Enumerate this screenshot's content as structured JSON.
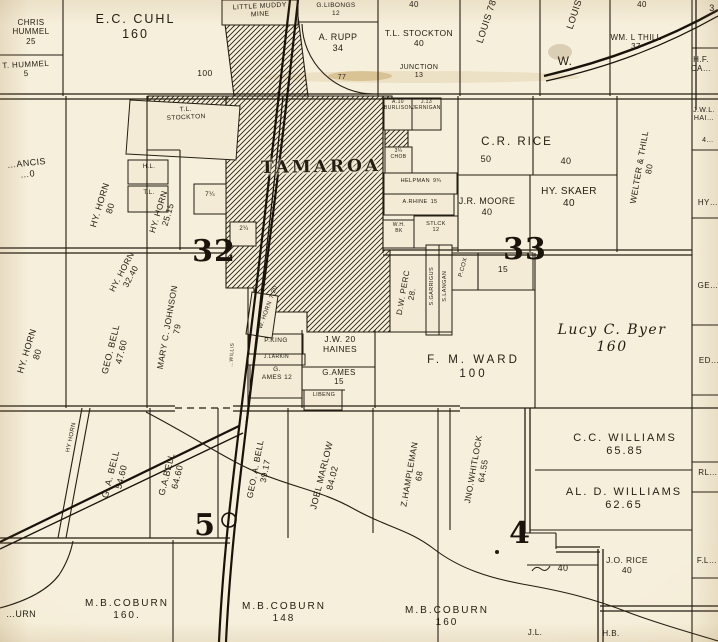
{
  "map": {
    "type": "plat-map",
    "town_name": "TAMAROA",
    "mine_name": "LITTLE MUDDY MINE",
    "section_numbers": [
      "32",
      "33",
      "5",
      "4"
    ],
    "paper_color": "#f3ebd5",
    "ink_color": "#241c10",
    "labels": [
      {
        "t": "CHRIS HUMMEL",
        "v": "25"
      },
      {
        "t": "T. HUMMEL",
        "v": "5"
      },
      {
        "t": "E.C. CUHL",
        "v": "160"
      },
      {
        "t": "100"
      },
      {
        "t": "LITTLE MUDDY MINE"
      },
      {
        "t": "G.LIBONGS",
        "v": "12"
      },
      {
        "t": "A. RUPP",
        "v": "34"
      },
      {
        "t": "77"
      },
      {
        "t": "T.L. STOCKTON",
        "v": "40"
      },
      {
        "t": "JUNCTION",
        "v": "13"
      },
      {
        "t": "LOUIS",
        "v": "78"
      },
      {
        "t": "LOUIS",
        "v": "78"
      },
      {
        "t": "W."
      },
      {
        "t": "WM. L THILL",
        "v": "37"
      },
      {
        "t": "H.F.",
        "v": "CA…"
      },
      {
        "t": "40"
      },
      {
        "t": "40"
      },
      {
        "t": "3"
      },
      {
        "t": "…ANCIS",
        "v": "…0"
      },
      {
        "t": "HY. HORN",
        "v": "80"
      },
      {
        "t": "HY. HORN",
        "v": "25.15"
      },
      {
        "t": "T.L.",
        "v": "STOCKTON"
      },
      {
        "t": "H.L."
      },
      {
        "t": "T.L."
      },
      {
        "t": "7¼"
      },
      {
        "t": "2¼"
      },
      {
        "t": "TAMAROA"
      },
      {
        "t": "A.10",
        "v": "BURLISON"
      },
      {
        "t": "J.13",
        "v": "JERNIGAN"
      },
      {
        "t": "3¼",
        "v": "CHOB"
      },
      {
        "t": "HELPMAN",
        "v": "9¾"
      },
      {
        "t": "A.RHINE",
        "v": "15"
      },
      {
        "t": "W.H.",
        "v": "BK"
      },
      {
        "t": "STLCK",
        "v": "12"
      },
      {
        "t": "C.R. RICE"
      },
      {
        "t": "50"
      },
      {
        "t": "40"
      },
      {
        "t": "J.R. MOORE",
        "v": "40"
      },
      {
        "t": "HY. SKAER",
        "v": "40"
      },
      {
        "t": "WELTER & THILL",
        "v": "80"
      },
      {
        "t": "J.W.L.",
        "v": "HAI…"
      },
      {
        "t": "4…"
      },
      {
        "t": "HY…"
      },
      {
        "t": "32"
      },
      {
        "t": "33"
      },
      {
        "t": "HY. HORN",
        "v": "80"
      },
      {
        "t": "HY. HORN",
        "v": "32.40"
      },
      {
        "t": "GEO. BELL",
        "v": "47.60"
      },
      {
        "t": "MARY C. JOHNSON",
        "v": "79"
      },
      {
        "t": "W. HORN",
        "v": "7.20"
      },
      {
        "t": "P.KING"
      },
      {
        "t": "J.LARKIN"
      },
      {
        "t": "G.",
        "v": "AMES 12"
      },
      {
        "t": "…WILLIS"
      },
      {
        "t": "J.W. 20",
        "v": "HAINES"
      },
      {
        "t": "G.AMES",
        "v": "15"
      },
      {
        "t": "LIBENG"
      },
      {
        "t": "D.W. PERC",
        "v": "28."
      },
      {
        "t": "S.GARRIGUS"
      },
      {
        "t": "S.LANGAN"
      },
      {
        "t": "P.COX"
      },
      {
        "t": "15"
      },
      {
        "t": "F. M. WARD",
        "v": "100"
      },
      {
        "t": "Lucy C. Byer",
        "v": "160"
      },
      {
        "t": "GE…"
      },
      {
        "t": "ED…"
      },
      {
        "t": "HY HORN"
      },
      {
        "t": "G. A. BELL",
        "v": "54.60"
      },
      {
        "t": "G.A.BELL",
        "v": "64.60"
      },
      {
        "t": "GEO. A. BELL",
        "v": "39.17"
      },
      {
        "t": "JOEL MARLOW",
        "v": "84.02"
      },
      {
        "t": "Z.HAMPLEMAN",
        "v": "68"
      },
      {
        "t": "JNO.WHITLOCK",
        "v": "64.55"
      },
      {
        "t": "C.C. WILLIAMS",
        "v": "65.85"
      },
      {
        "t": "AL. D. WILLIAMS",
        "v": "62.65"
      },
      {
        "t": "RL…"
      },
      {
        "t": "4"
      },
      {
        "t": "5"
      },
      {
        "t": "40"
      },
      {
        "t": "J.O. RICE",
        "v": "40"
      },
      {
        "t": "F.L…"
      },
      {
        "t": "M.B.COBURN",
        "v": "160."
      },
      {
        "t": "M.B.COBURN",
        "v": "148"
      },
      {
        "t": "M.B.COBURN",
        "v": "160"
      },
      {
        "t": "J.L."
      },
      {
        "t": "H.B."
      },
      {
        "t": "…URN"
      }
    ]
  }
}
